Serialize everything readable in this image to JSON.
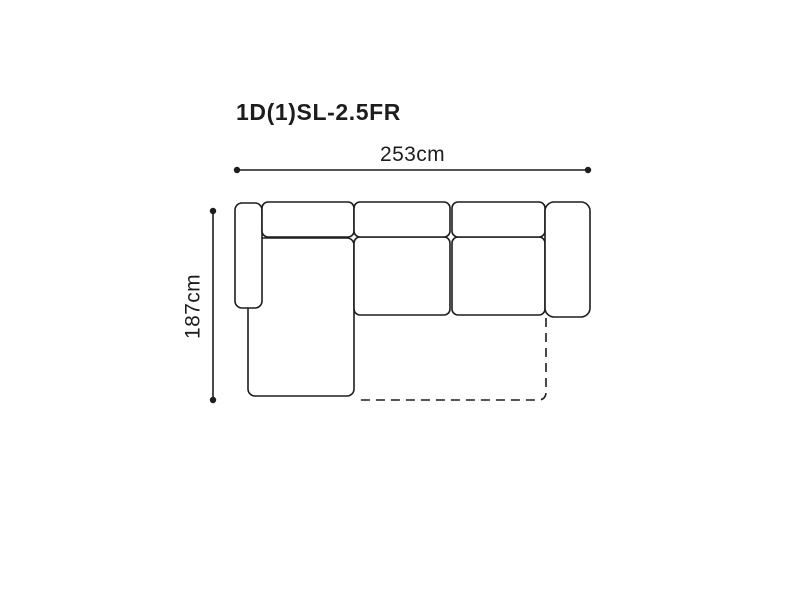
{
  "diagram": {
    "title": "1D(1)SL-2.5FR",
    "width_label": "253cm",
    "depth_label": "187cm",
    "line_color": "#1d1d1b",
    "background_color": "#ffffff"
  }
}
